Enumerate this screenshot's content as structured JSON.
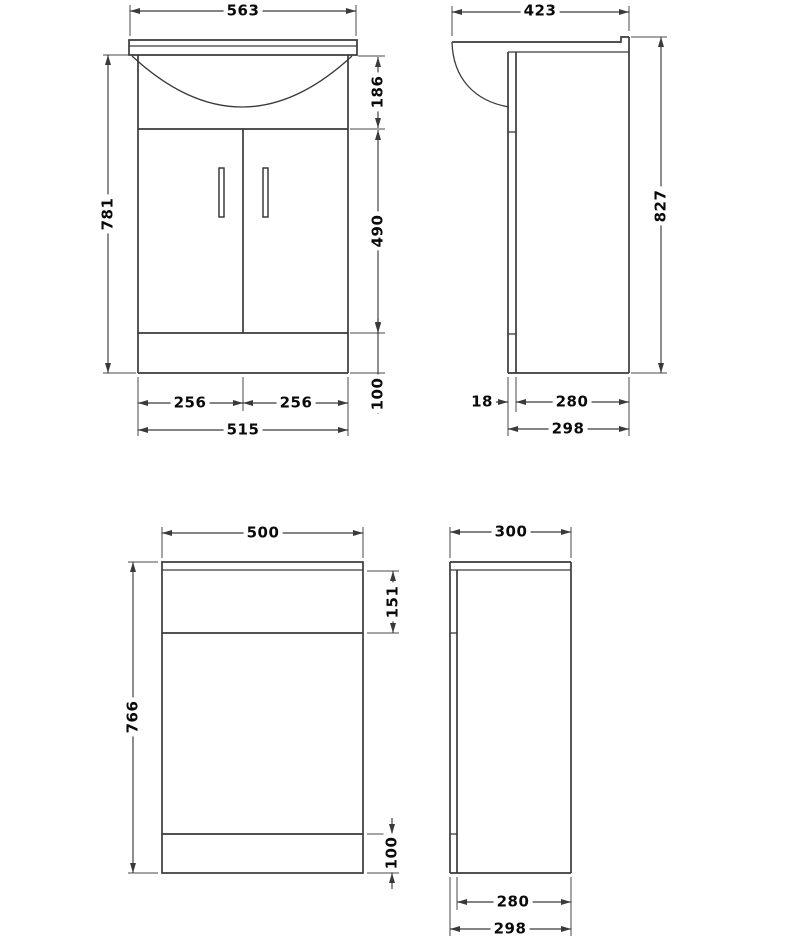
{
  "meta": {
    "drawing_type": "technical-dimension-drawing",
    "subject": "Bathroom basin vanity unit and WC unit - front and side elevations with millimetre dimensions",
    "background_color": "#ffffff",
    "line_color": "#3a3a3a",
    "text_color": "#0a0a0a"
  },
  "views": {
    "vanity_front": {
      "label": "basin vanity front elevation"
    },
    "vanity_side": {
      "label": "basin vanity side elevation"
    },
    "wc_front": {
      "label": "WC unit front elevation"
    },
    "wc_side": {
      "label": "WC unit side elevation"
    }
  },
  "dims": {
    "vanity_front": {
      "counter_width": "563",
      "overall_height": "781",
      "basin_section_height": "186",
      "door_section_height": "490",
      "plinth_height": "100",
      "left_door_width": "256",
      "right_door_width": "256",
      "cabinet_width": "515"
    },
    "vanity_side": {
      "counter_depth": "423",
      "overall_height": "827",
      "door_thickness": "18",
      "carcass_depth": "280",
      "overall_depth": "298"
    },
    "wc_front": {
      "width": "500",
      "overall_height": "766",
      "top_section_height": "151",
      "plinth_height": "100"
    },
    "wc_side": {
      "top_depth": "300",
      "carcass_depth": "280",
      "overall_depth": "298"
    }
  }
}
